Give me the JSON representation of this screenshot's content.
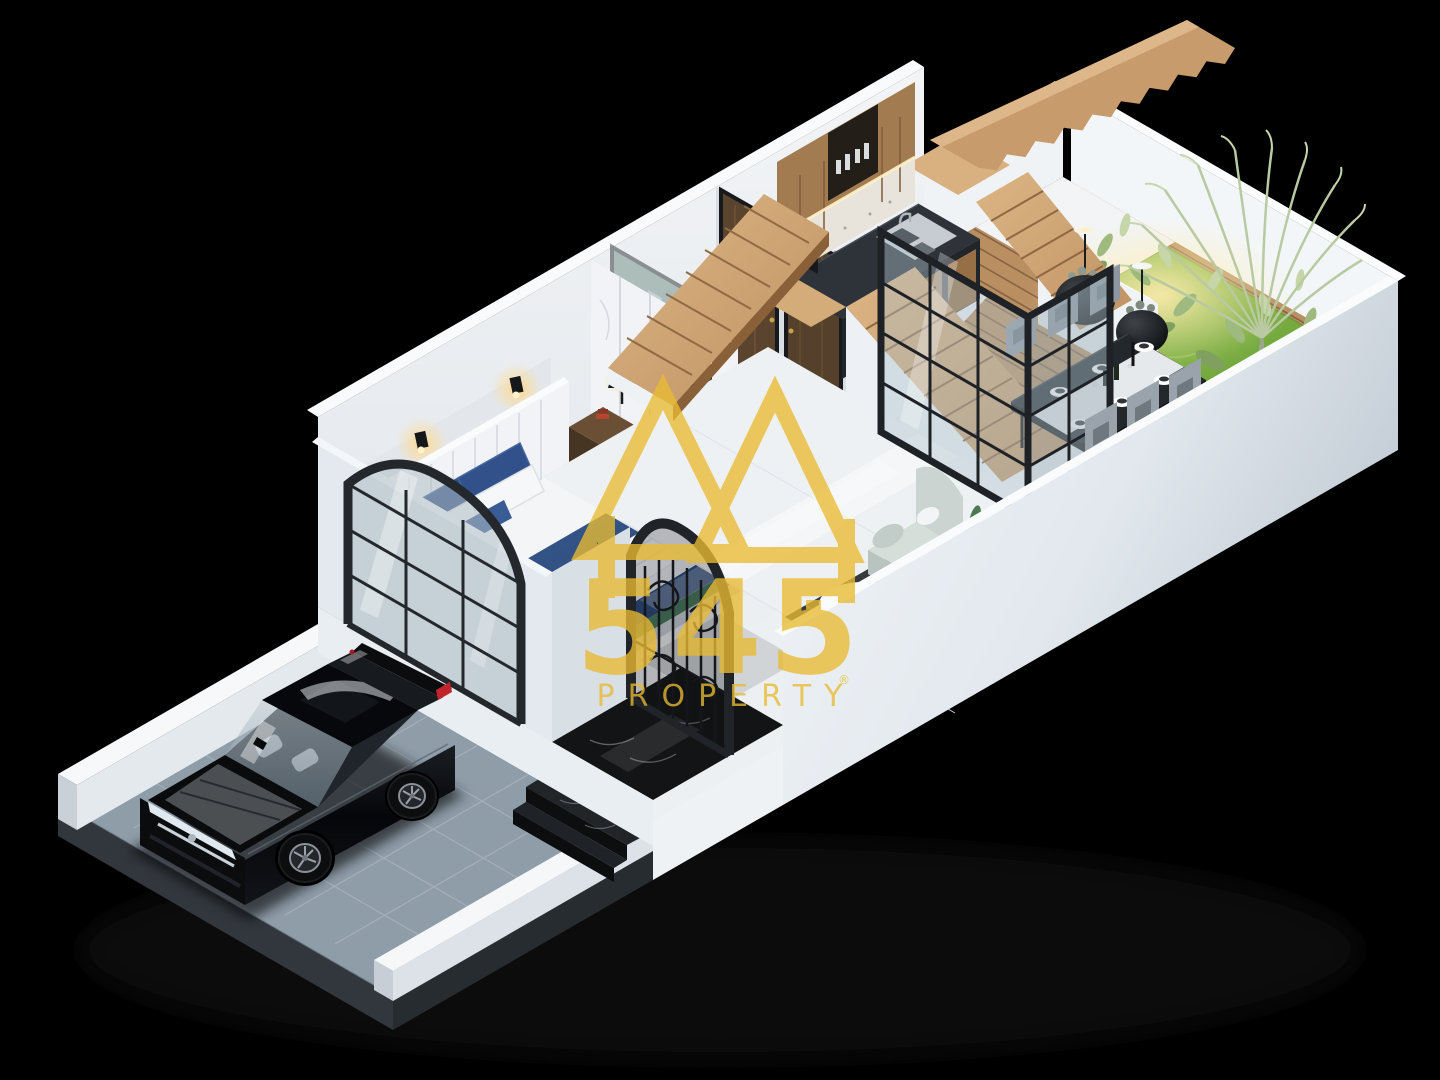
{
  "watermark": {
    "number": "545",
    "word": "PROPERTY",
    "registered": "®",
    "color": "#E9BB33",
    "logo": "twin-mountain-triangles"
  },
  "palette": {
    "background": "#000000",
    "platform_white": "#F1F4F7",
    "wall_shadow": "#C7CED6",
    "driveway_tile": "#8F9DA9",
    "wood_stair": "#C99F6F",
    "deck_wood": "#B98F62",
    "kitchen_wood": "#A37B50",
    "grass_green": "#7DB344",
    "marble_black": "#141619",
    "bed_navy": "#2F4F82",
    "bed_green": "#47795D",
    "glass_tint": "#AFC2CB",
    "frame_black": "#1E2226",
    "car_black": "#0B0C0E",
    "sofa_sage": "#CBD4D0",
    "chair_gray": "#99A2AA",
    "gold": "#E9BB33"
  },
  "scene": {
    "type": "isometric-3d-floor-plan-render",
    "elements": [
      "black sedan on driveway",
      "tiled driveway",
      "arched steel window",
      "bedroom with double bed",
      "marble wardrobe",
      "bedside lamps",
      "wrought-iron entry gate",
      "black marble entry steps",
      "bathroom doors",
      "glass partition",
      "wooden staircase",
      "floating upper staircase",
      "kitchen cabinets and counter with sink",
      "dining table with chairs",
      "living armchair with coffee table",
      "wooden deck terrace",
      "grass lawn",
      "tropical plants",
      "perimeter white walls"
    ]
  }
}
